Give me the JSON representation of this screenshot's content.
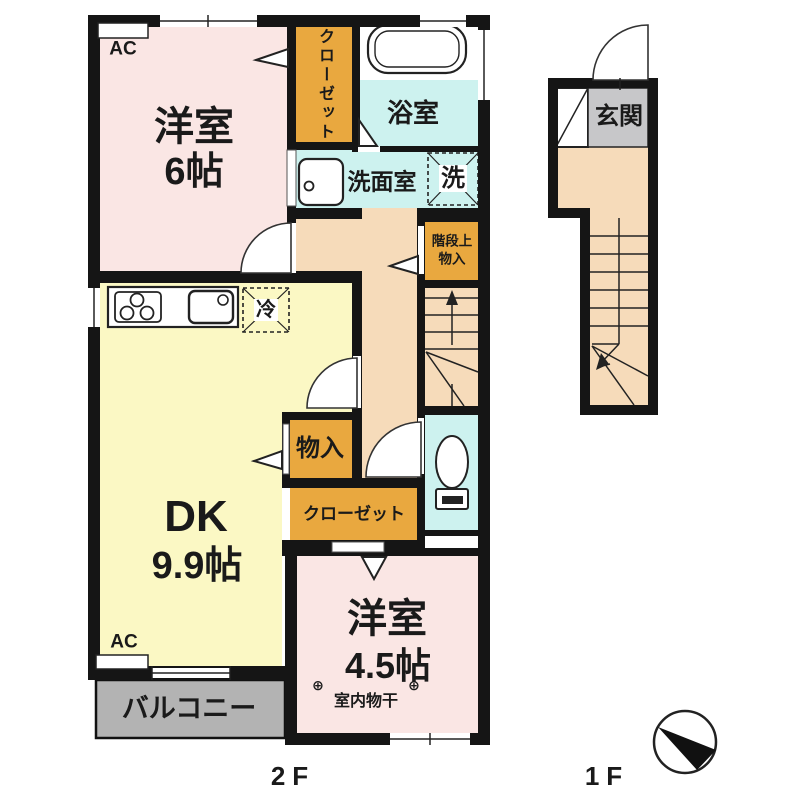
{
  "colors": {
    "room_pink": "#FAE6E4",
    "closet_orange": "#E9A83F",
    "wet_area_cyan": "#CDF2EF",
    "dk_yellow": "#FBF8C4",
    "hall_peach": "#F6DBBA",
    "balcony_gray": "#B3B3B3",
    "genkan_gray": "#C7C7C9",
    "wall_black": "#151515"
  },
  "floor2": {
    "label": "2F",
    "room_west6": {
      "name": "洋室",
      "size": "6帖"
    },
    "closet_north": "クローゼット",
    "bath": "浴室",
    "washroom": "洗面室",
    "washer_mark": "洗",
    "stair_storage": {
      "line1": "階段上",
      "line2": "物入"
    },
    "fridge_mark": "冷",
    "dk": {
      "name": "DK",
      "size": "9.9帖"
    },
    "storage": "物入",
    "closet_south": "クローゼット",
    "room_south45": {
      "name": "洋室",
      "size": "4.5帖"
    },
    "drying": {
      "symbol": "⊕",
      "label": "室内物干"
    },
    "balcony": "バルコニー",
    "ac_label": "AC"
  },
  "floor1": {
    "label": "1F",
    "entrance": "玄関"
  }
}
